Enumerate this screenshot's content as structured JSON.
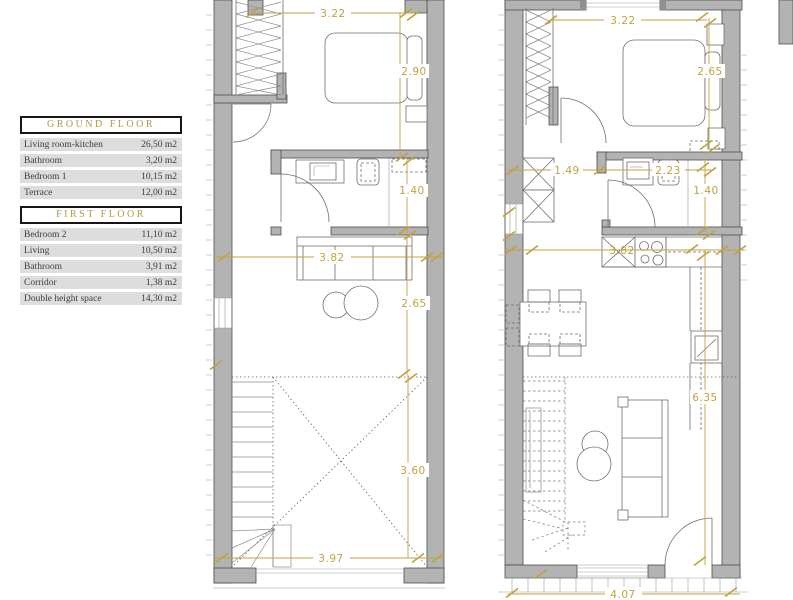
{
  "legend": {
    "sections": [
      {
        "title": "GROUND FLOOR",
        "rows": [
          {
            "label": "Living room-kitchen",
            "value": "26,50 m2"
          },
          {
            "label": "Bathroom",
            "value": "3,20 m2"
          },
          {
            "label": "Bedroom 1",
            "value": "10,15 m2"
          },
          {
            "label": "Terrace",
            "value": "12,00 m2"
          }
        ]
      },
      {
        "title": "FIRST FLOOR",
        "rows": [
          {
            "label": "Bedroom 2",
            "value": "11,10 m2"
          },
          {
            "label": "Living",
            "value": "10,50 m2"
          },
          {
            "label": "Bathroom",
            "value": "3,91 m2"
          },
          {
            "label": "Corridor",
            "value": "1,38 m2"
          },
          {
            "label": "Double height space",
            "value": "14,30 m2"
          }
        ]
      }
    ]
  },
  "plans": {
    "first_floor": {
      "dims": {
        "top_width": "3.22",
        "bedroom_depth": "2.90",
        "bathroom_depth": "1.40",
        "living_width": "3.82",
        "living_depth": "2.65",
        "void_depth": "3.60",
        "bottom_width": "3.97"
      }
    },
    "ground_floor": {
      "dims": {
        "top_width": "3.22",
        "bedroom_depth": "2.65",
        "hall_width": "1.49",
        "bathroom_width": "2.23",
        "bathroom_depth": "1.40",
        "kitchen_width": "3.82",
        "living_depth": "6.35",
        "terrace_width": "4.07"
      }
    }
  },
  "colors": {
    "dimension_gold": "#c2a23e",
    "wall_gray": "#b3b3b3",
    "legend_header_text": "#ab9c3b",
    "legend_row_bg": "#dcdddd"
  }
}
